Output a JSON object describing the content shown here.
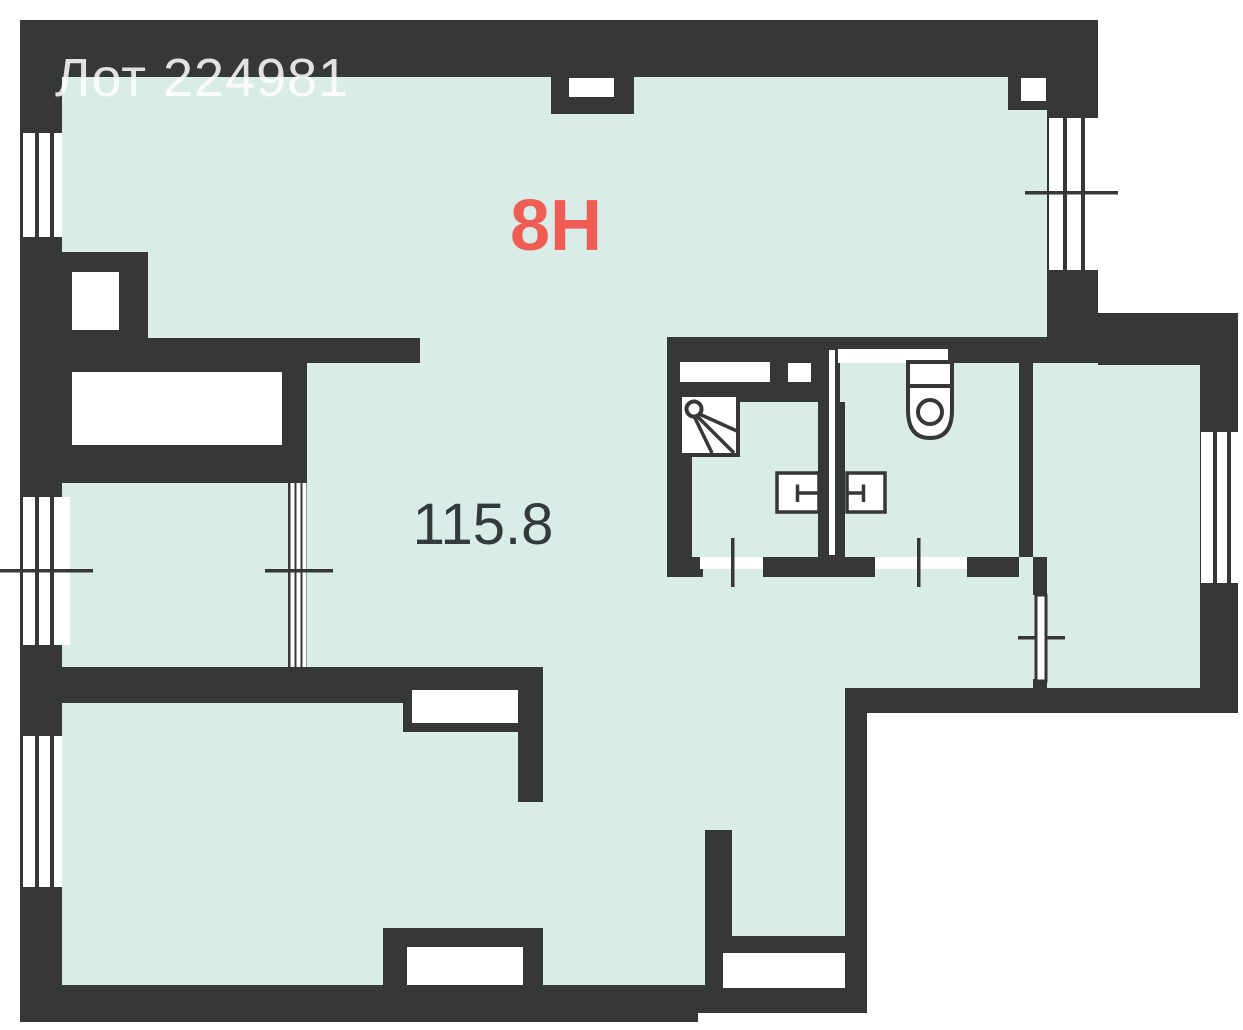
{
  "floor_plan": {
    "lot_label": "Лот 224981",
    "unit_label": "8Н",
    "area_label": "115.8",
    "fixtures": [
      "shower-icon",
      "sink-icon",
      "sink-icon",
      "toilet-icon"
    ]
  },
  "theme": {
    "background": "#ffffff",
    "wall_color": "#353738",
    "room_fill": "#d9ece8",
    "unit_accent": "#f05d54",
    "area_text_color": "#333a3c",
    "lot_text_color": "rgba(255,255,255,0.85)"
  }
}
